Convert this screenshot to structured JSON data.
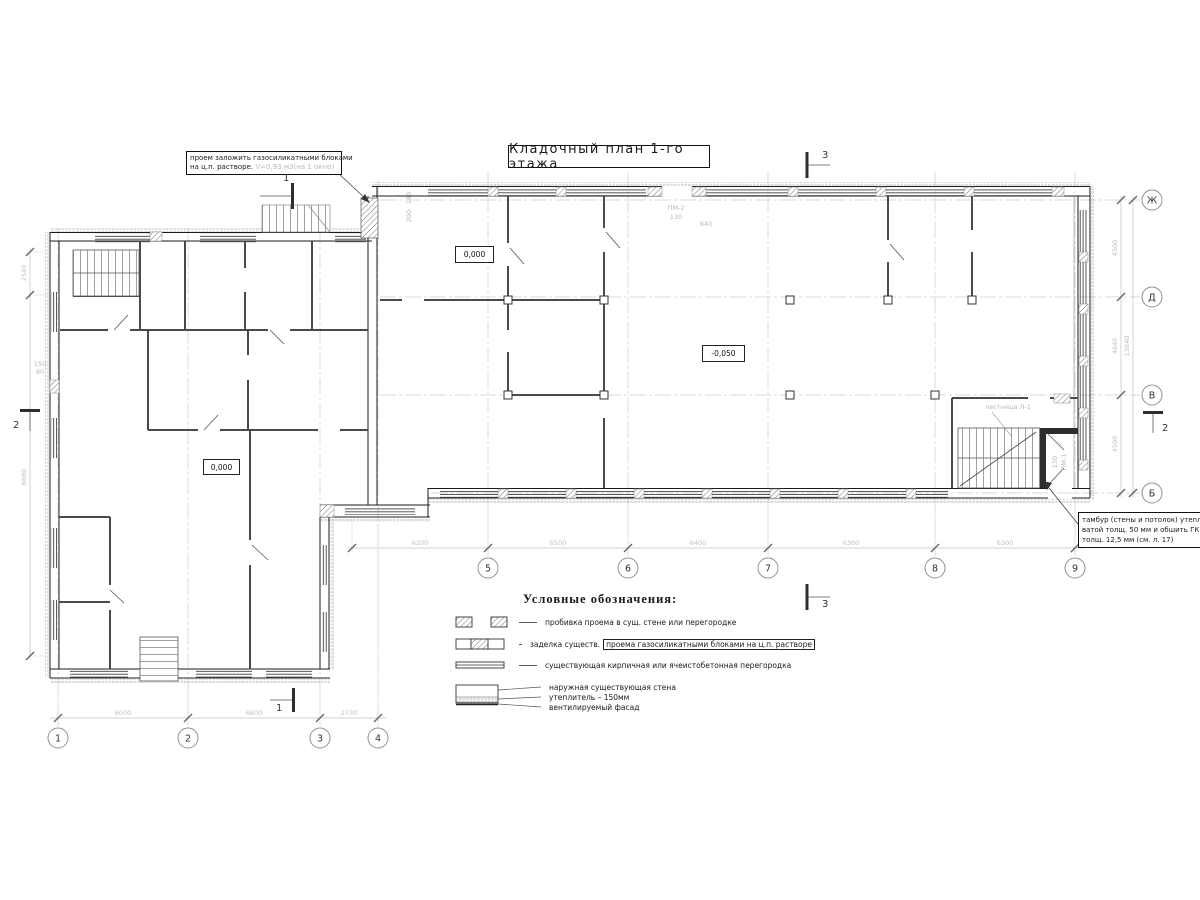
{
  "title": "Кладочный план 1-го этажа",
  "notes": {
    "opening": {
      "line1": "проем заложить газосиликатными блоками",
      "line2": "на ц.п. растворе.",
      "volume": "V=0,93 м3(на 1 окно)"
    },
    "tambour": {
      "line1": "тамбур (стены и потолок) утепли",
      "line2": "ватой толщ. 50 мм и обшить ГК",
      "line3": "толщ. 12,5 мм (см. л. 17)"
    }
  },
  "levels": {
    "entry": "0,000",
    "left": "0,000",
    "hall": "-0,050"
  },
  "legend": {
    "heading": "Условные обозначения:",
    "item1": "пробивка проема  в сущ. стене  или перегородке",
    "item2_prefix": "заделка существ.",
    "item2_boxed": "проема газосиликатными блоками на ц.п. растворе",
    "item3": "существующая кирпичная или ячеистобетонная перегородка",
    "wall1": "наружная существующая стена",
    "wall2": "утеплитель – 150мм",
    "wall3": "вентилируемый фасад"
  },
  "axes": {
    "bottom_left": {
      "n1": "1",
      "n2": "2",
      "n3": "3",
      "n4": "4",
      "d1": "6000",
      "d2": "6800",
      "d3": "2730"
    },
    "bottom_mid": {
      "n1": "5",
      "n2": "6",
      "n3": "7",
      "n4": "8",
      "n5": "9",
      "d0": "6200",
      "d1": "6500",
      "d2": "6400",
      "d3": "6300",
      "d4": "6300"
    },
    "right": {
      "a1": "Ж",
      "a2": "Д",
      "a3": "В",
      "a4": "Б",
      "d1": "4500",
      "d2": "4840",
      "d3": "4500",
      "total": "13840"
    },
    "left": {
      "d1": "2540",
      "d2": "6680"
    }
  },
  "sections": {
    "s1": "1",
    "s2": "2",
    "s3": "3"
  },
  "labels": {
    "stair": "лестница Л-1",
    "pm2": "ПМ-2",
    "pm2_width": "130",
    "pm2_dim": "840",
    "pm1": "ПМ-1",
    "pm1_width": "130",
    "d150": "150",
    "d80": "80",
    "d140": "140",
    "d200": "200"
  }
}
